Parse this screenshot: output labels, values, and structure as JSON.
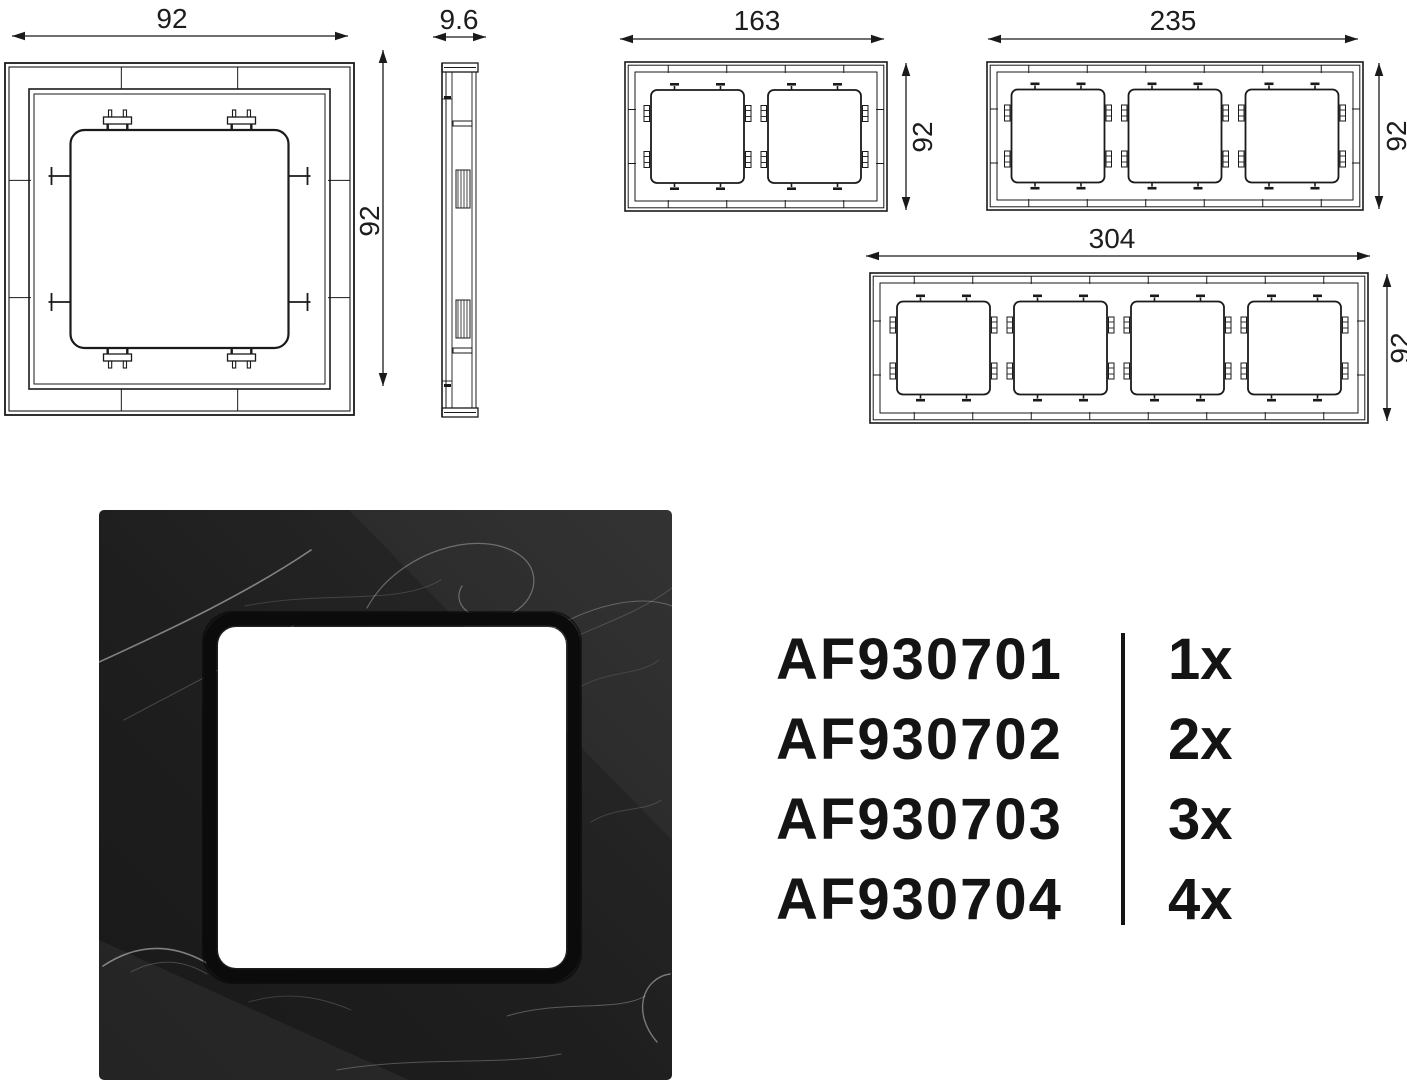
{
  "page": {
    "background": "#ffffff",
    "ink_color": "#1a1a1a",
    "text_color": "#141414"
  },
  "drawings": {
    "one_gang_front": {
      "width_label": "92",
      "height_label": "92"
    },
    "side_profile": {
      "depth_label": "9.6"
    },
    "two_gang_front": {
      "width_label": "163",
      "height_label": "92"
    },
    "three_gang_front": {
      "width_label": "235",
      "height_label": "92"
    },
    "four_gang_front": {
      "width_label": "304",
      "height_label": "92"
    }
  },
  "product_photo": {
    "frame_dark_color": "#191919",
    "frame_light_color": "#2b2b2b",
    "vein_color": "#e6e6e6",
    "bezel_color": "#0b0b0b",
    "window_color": "#ffffff"
  },
  "order_table": {
    "rows": [
      {
        "code": "AF930701",
        "quantity": "1x"
      },
      {
        "code": "AF930702",
        "quantity": "2x"
      },
      {
        "code": "AF930703",
        "quantity": "3x"
      },
      {
        "code": "AF930704",
        "quantity": "4x"
      }
    ]
  }
}
